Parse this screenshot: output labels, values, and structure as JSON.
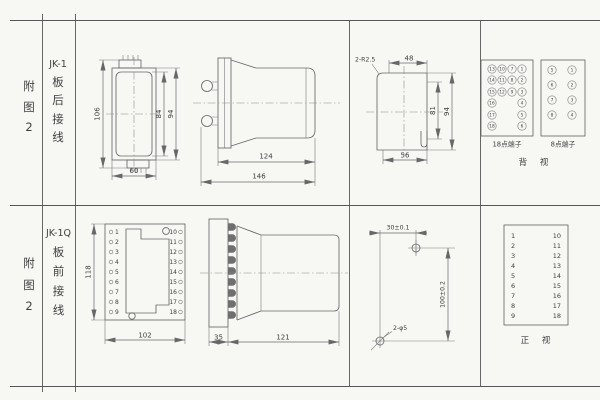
{
  "sheet": {
    "bg_color": "#f7f7f4",
    "line_color": "#686868",
    "text_color": "#3e3e3e"
  },
  "rows": [
    {
      "figure_chars": [
        "附",
        "图",
        "2"
      ],
      "model": "JK-1",
      "wiring_chars": [
        "板",
        "后",
        "接",
        "线"
      ]
    },
    {
      "figure_chars": [
        "附",
        "图",
        "2"
      ],
      "model": "JK-1Q",
      "wiring_chars": [
        "板",
        "前",
        "接",
        "线"
      ]
    }
  ],
  "top_row": {
    "front_view": {
      "dim_total_height": "106",
      "dim_inner_height": "84",
      "dim_body_height": "94",
      "dim_width": "60"
    },
    "side_view": {
      "dim_body_length": "124",
      "dim_total_length": "146"
    },
    "panel_cutout": {
      "corner_radius_label": "2-R2.5",
      "dim_top_width": "48",
      "dim_inner_height": "81",
      "dim_height": "94",
      "dim_width": "56"
    },
    "rear_terminals": {
      "block18_caption": "18点端子",
      "block8_caption": "8点端子",
      "view_label": "背 视",
      "block18": {
        "col1": [
          "13",
          "14",
          "15",
          "16",
          "17",
          "18"
        ],
        "col2": [
          "10",
          "11",
          "12"
        ],
        "col3": [
          "7",
          "8",
          "9"
        ],
        "col4": [
          "1",
          "2",
          "3",
          "4",
          "5",
          "6"
        ]
      },
      "block8": {
        "left": [
          "5",
          "6",
          "7",
          "8"
        ],
        "right": [
          "1",
          "2",
          "3",
          "4"
        ]
      }
    }
  },
  "bottom_row": {
    "front_view": {
      "dim_height": "118",
      "dim_width": "102",
      "left_terminals": [
        "1",
        "2",
        "3",
        "4",
        "5",
        "6",
        "7",
        "8",
        "9"
      ],
      "right_terminals": [
        "10",
        "11",
        "12",
        "13",
        "14",
        "15",
        "16",
        "17",
        "18"
      ]
    },
    "side_view": {
      "dim_plate": "35",
      "dim_body": "121"
    },
    "drill_template": {
      "dim_horizontal": "30±0.1",
      "dim_vertical": "100±0.2",
      "hole_label": "2-φ5"
    },
    "terminal_list": {
      "left": [
        "1",
        "2",
        "3",
        "4",
        "5",
        "6",
        "7",
        "8",
        "9"
      ],
      "right": [
        "10",
        "11",
        "12",
        "13",
        "14",
        "15",
        "16",
        "17",
        "18"
      ],
      "view_label": "正 视"
    }
  }
}
